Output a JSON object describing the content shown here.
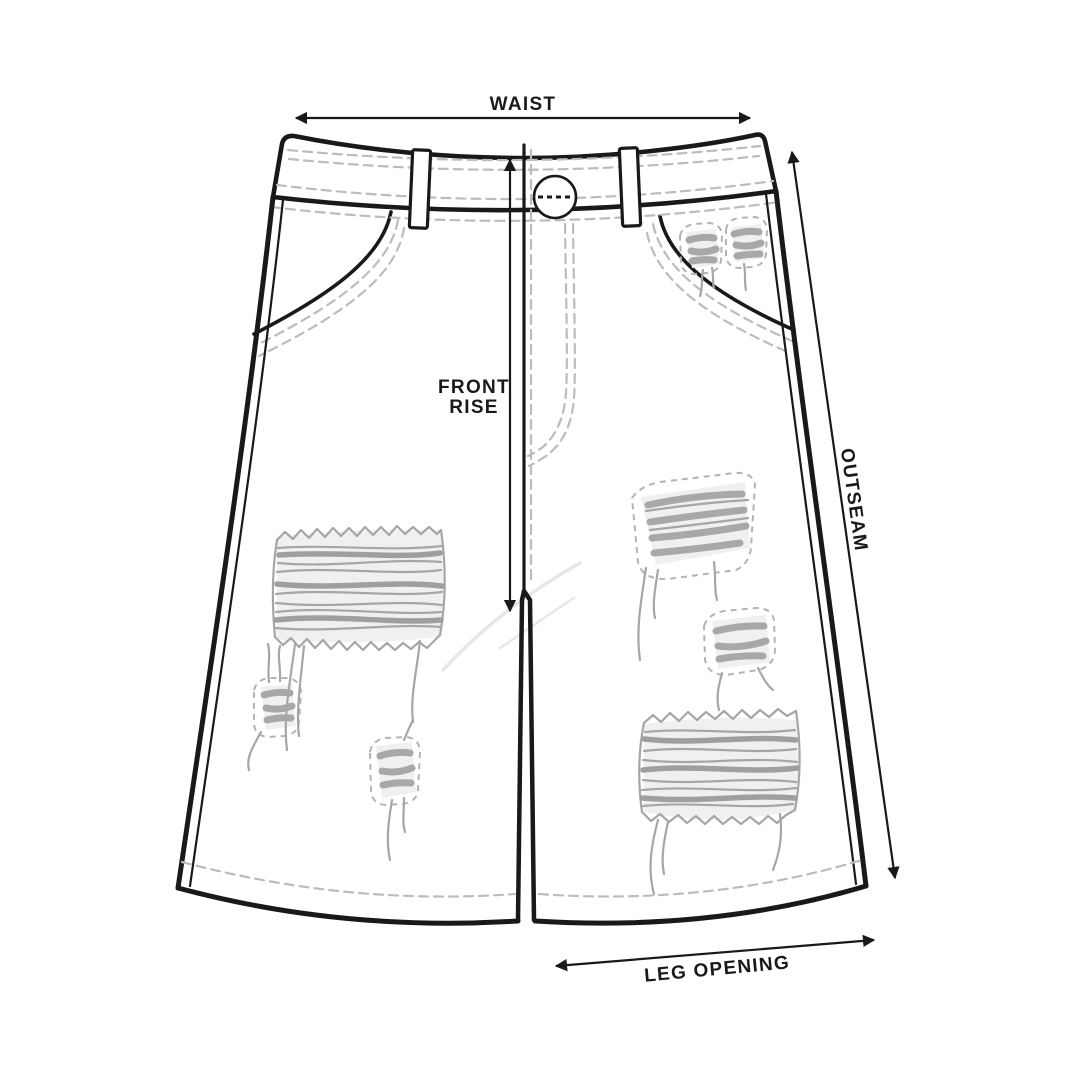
{
  "page": {
    "background_color": "#ffffff"
  },
  "drawing": {
    "type": "technical-flat-sketch",
    "garment": "distressed denim shorts (front view)",
    "measurement_labels": {
      "waist": "WAIST",
      "front_rise_line1": "FRONT",
      "front_rise_line2": "RISE",
      "outseam": "OUTSEAM",
      "leg_opening": "LEG OPENING"
    },
    "colors": {
      "line": "#191919",
      "stitch_dash": "#bcbcbc",
      "distress": "#a6a6a6",
      "distress_fill": "#f0f0f0",
      "whisker": "#e7e7e7",
      "background": "#ffffff"
    },
    "features": [
      "waistband with button and belt loops",
      "front rise dimension arrow",
      "curved front pockets",
      "ripped distress patches with fraying threads",
      "outseam dimension arrow",
      "leg opening dimension arrow"
    ]
  }
}
